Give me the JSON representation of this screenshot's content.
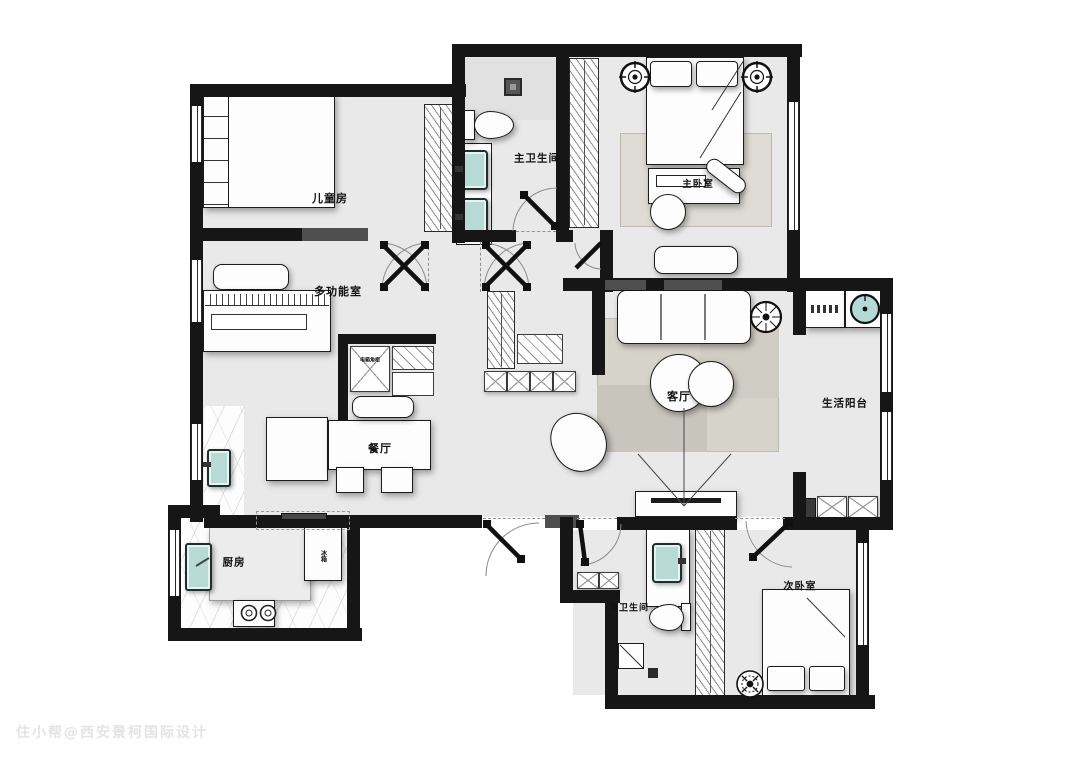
{
  "watermark": "住小帮@西安景柯国际设计",
  "rooms": {
    "children_room": {
      "label": "儿童房"
    },
    "master_bath": {
      "label": "主卫生间"
    },
    "master_bedroom": {
      "label": "主卧室"
    },
    "multi_function": {
      "label": "多功能室"
    },
    "living_room": {
      "label": "客厅"
    },
    "life_balcony": {
      "label": "生活阳台"
    },
    "dining_room": {
      "label": "餐厅"
    },
    "kitchen": {
      "label": "厨房"
    },
    "second_bath": {
      "label": "次卫生间"
    },
    "second_bedroom": {
      "label": "次卧室"
    }
  },
  "annotations": {
    "corner_cabinet": {
      "label": "电箱角柜"
    },
    "fridge": {
      "label": "冰箱"
    }
  },
  "colors": {
    "wall": "#161616",
    "floor": "#e9e9e9",
    "fixture_teal": "#b7dad5",
    "rug": "#d6d3cb",
    "watermark": "#e4e4e4"
  }
}
